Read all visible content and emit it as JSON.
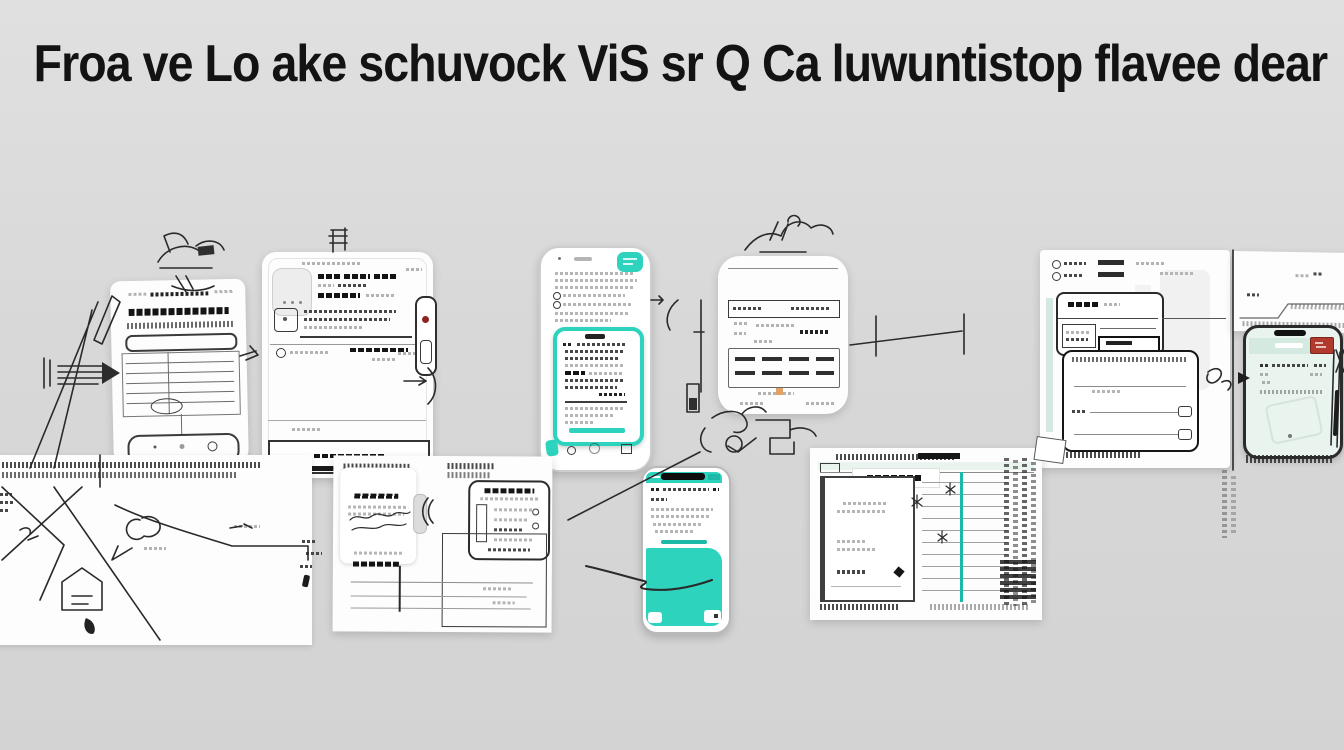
{
  "title": {
    "text": "Froa ve Lo ake schuvock ViS sr Q Ca luwuntistop flavee dear"
  },
  "colors": {
    "bg-top": "#e0e0e0",
    "bg-mid": "#d8d8d8",
    "bg-bottom": "#d3d3d3",
    "paper": "#fdfdfd",
    "ink": "#2e2e2e",
    "teal": "#2ed3be",
    "teal-deep": "#1db9a8",
    "mint": "#d4e9e0",
    "mint-pale": "#e9f4ef",
    "stamp-red": "#b03a2e",
    "accent-orange": "#e3a265"
  },
  "scene": {
    "figures": [
      "document-sheet",
      "profile-card",
      "teal-frame-phone",
      "tablet-panel",
      "window-stack",
      "stamped-mint-phone",
      "schematic-sketch",
      "form-documents",
      "teal-screen-phone",
      "ledger-sheet"
    ]
  }
}
